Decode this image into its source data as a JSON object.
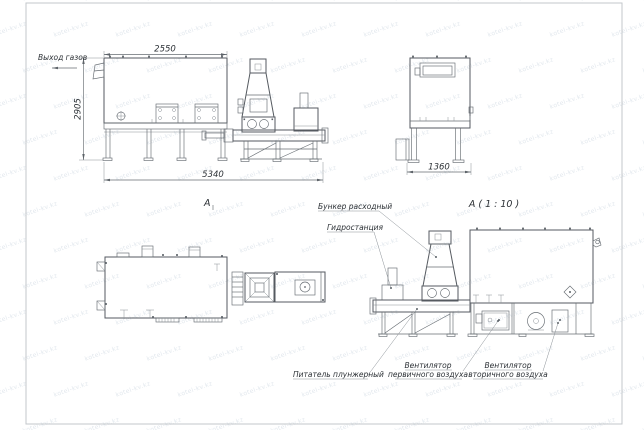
{
  "watermark": {
    "text": "kotel-kv.kz"
  },
  "dimensions": {
    "front_width": "2550",
    "front_height": "2905",
    "overall_length": "5340",
    "side_depth": "1360"
  },
  "labels": {
    "gas_outlet": "Выход газов",
    "section_mark": "А",
    "detail_title": "А ( 1 : 10 )",
    "hopper": "Бункер расходный",
    "hydraulic_station": "Гидростанция",
    "plunger_feeder": "Питатель плунжерный",
    "primary_fan_line1": "Вентилятор",
    "primary_fan_line2": "первичного воздуха",
    "secondary_fan_line1": "Вентилятор",
    "secondary_fan_line2": "вторичного воздуха"
  },
  "colors": {
    "line": "#666c72",
    "text": "#2c3136",
    "frame": "#c3c7cb",
    "watermark": "#9db0c4",
    "background": "#ffffff"
  }
}
